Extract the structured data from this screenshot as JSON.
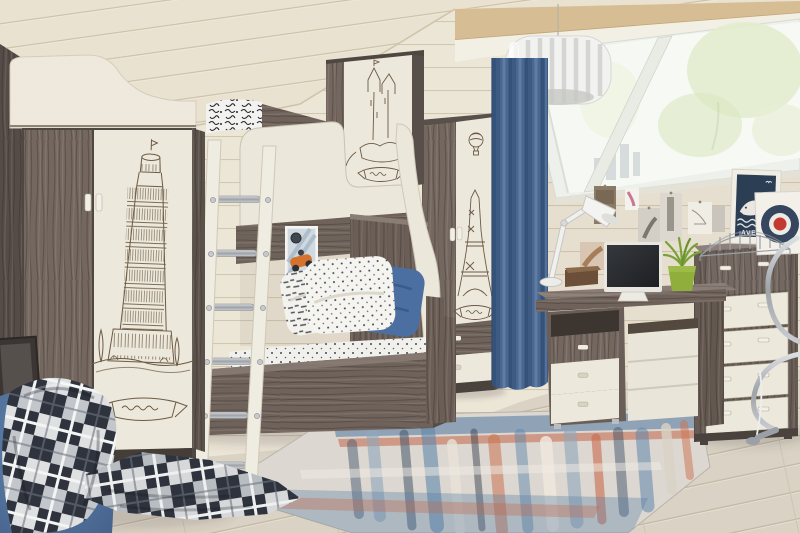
{
  "meta": {
    "type": "photograph",
    "subject": "children's attic bedroom furnished with a travel-sketch themed furniture set",
    "width": 800,
    "height": 533
  },
  "palette": {
    "wall_plank": "#ece6d7",
    "ceiling_plank": "#e9e2d0",
    "roof_beam_tan": "#d7bd93",
    "floor_wood": "#dad3c5",
    "dark_ash_wood": "#6e625b",
    "light_cream_wood": "#ece8db",
    "curtain_blue": "#4a678f",
    "pillow_blue": "#4b6fa0",
    "lime_green_pot": "#8fae3c",
    "rug_blue": "#5f87ac",
    "rug_coral": "#c96a4c",
    "plaid_dark": "#2e333d",
    "sketch_sepia": "#6d5a45",
    "poster_navy": "#2c3e54",
    "target_red": "#c23a31",
    "chrome": "#9ea3a8"
  },
  "objects": [
    {
      "name": "wardrobe-left",
      "desc": "tall two-door wardrobe, dark ash side and door, white door printed with a Leaning Tower of Pisa sketch and ribbon banner"
    },
    {
      "name": "bunk-bed",
      "desc": "bunk bed with white curved guard panels, dark ash rails and lower sofa-bed base"
    },
    {
      "name": "overhead-cabinet",
      "desc": "overhead cabinet above the bed with a castle sketch on the white door"
    },
    {
      "name": "ladder",
      "desc": "white ladder with chrome rungs leaning against the upper bunk"
    },
    {
      "name": "pillows",
      "desc": "white script-print pillow, navy polka-dot pillow and plain blue pillow on polka-dot bedding"
    },
    {
      "name": "race-car-poster",
      "desc": "small poster of an orange vintage race car in the bed alcove"
    },
    {
      "name": "wardrobe-narrow",
      "desc": "narrow wardrobe, dark door plus white door with hot-air balloon and Eiffel Tower sketch, two drawers below"
    },
    {
      "name": "curtain",
      "desc": "floor-length blue curtain beside the roof window"
    },
    {
      "name": "roof-window",
      "desc": "slanted attic roof window with two panes, trees and city visible outside"
    },
    {
      "name": "pendant-lamp",
      "desc": "white slatted drum pendant lamp hanging from the ceiling"
    },
    {
      "name": "desk",
      "desc": "writing desk with drawer pedestal: one dark and two white drawers"
    },
    {
      "name": "desk-lamp",
      "desc": "white articulated task lamp on the desk"
    },
    {
      "name": "monitor",
      "desc": "computer monitor with dark screen on the desk"
    },
    {
      "name": "wooden-box",
      "desc": "small wooden casket on the desk"
    },
    {
      "name": "plant",
      "desc": "green grassy plant in a lime pot"
    },
    {
      "name": "photo-wall",
      "desc": "black-and-white photos and prints pinned above the desk"
    },
    {
      "name": "whale-poster",
      "desc": "white-framed navy poster with white whale, waves and caption"
    },
    {
      "name": "target-poster",
      "desc": "white-framed roundel target print, navy ring with red centre"
    },
    {
      "name": "bridge-model",
      "desc": "wire bridge sculpture standing on the dresser"
    },
    {
      "name": "dresser",
      "desc": "chest of drawers, dark frame and top drawer with four white drawers"
    },
    {
      "name": "office-chair",
      "desc": "chrome cantilever desk chair, partly visible at right edge"
    },
    {
      "name": "rug",
      "desc": "abstract rug with blue, coral and cream brush-stroke pattern"
    },
    {
      "name": "bean-bag",
      "desc": "blue bean bag seat in the left foreground"
    },
    {
      "name": "plaid-blanket",
      "desc": "black, grey and white plaid blanket draped over the bean bag onto the floor"
    },
    {
      "name": "picture-board",
      "desc": "dark framed board leaning behind the bean bag"
    }
  ],
  "decor": {
    "whale_poster_caption": "AVE"
  }
}
